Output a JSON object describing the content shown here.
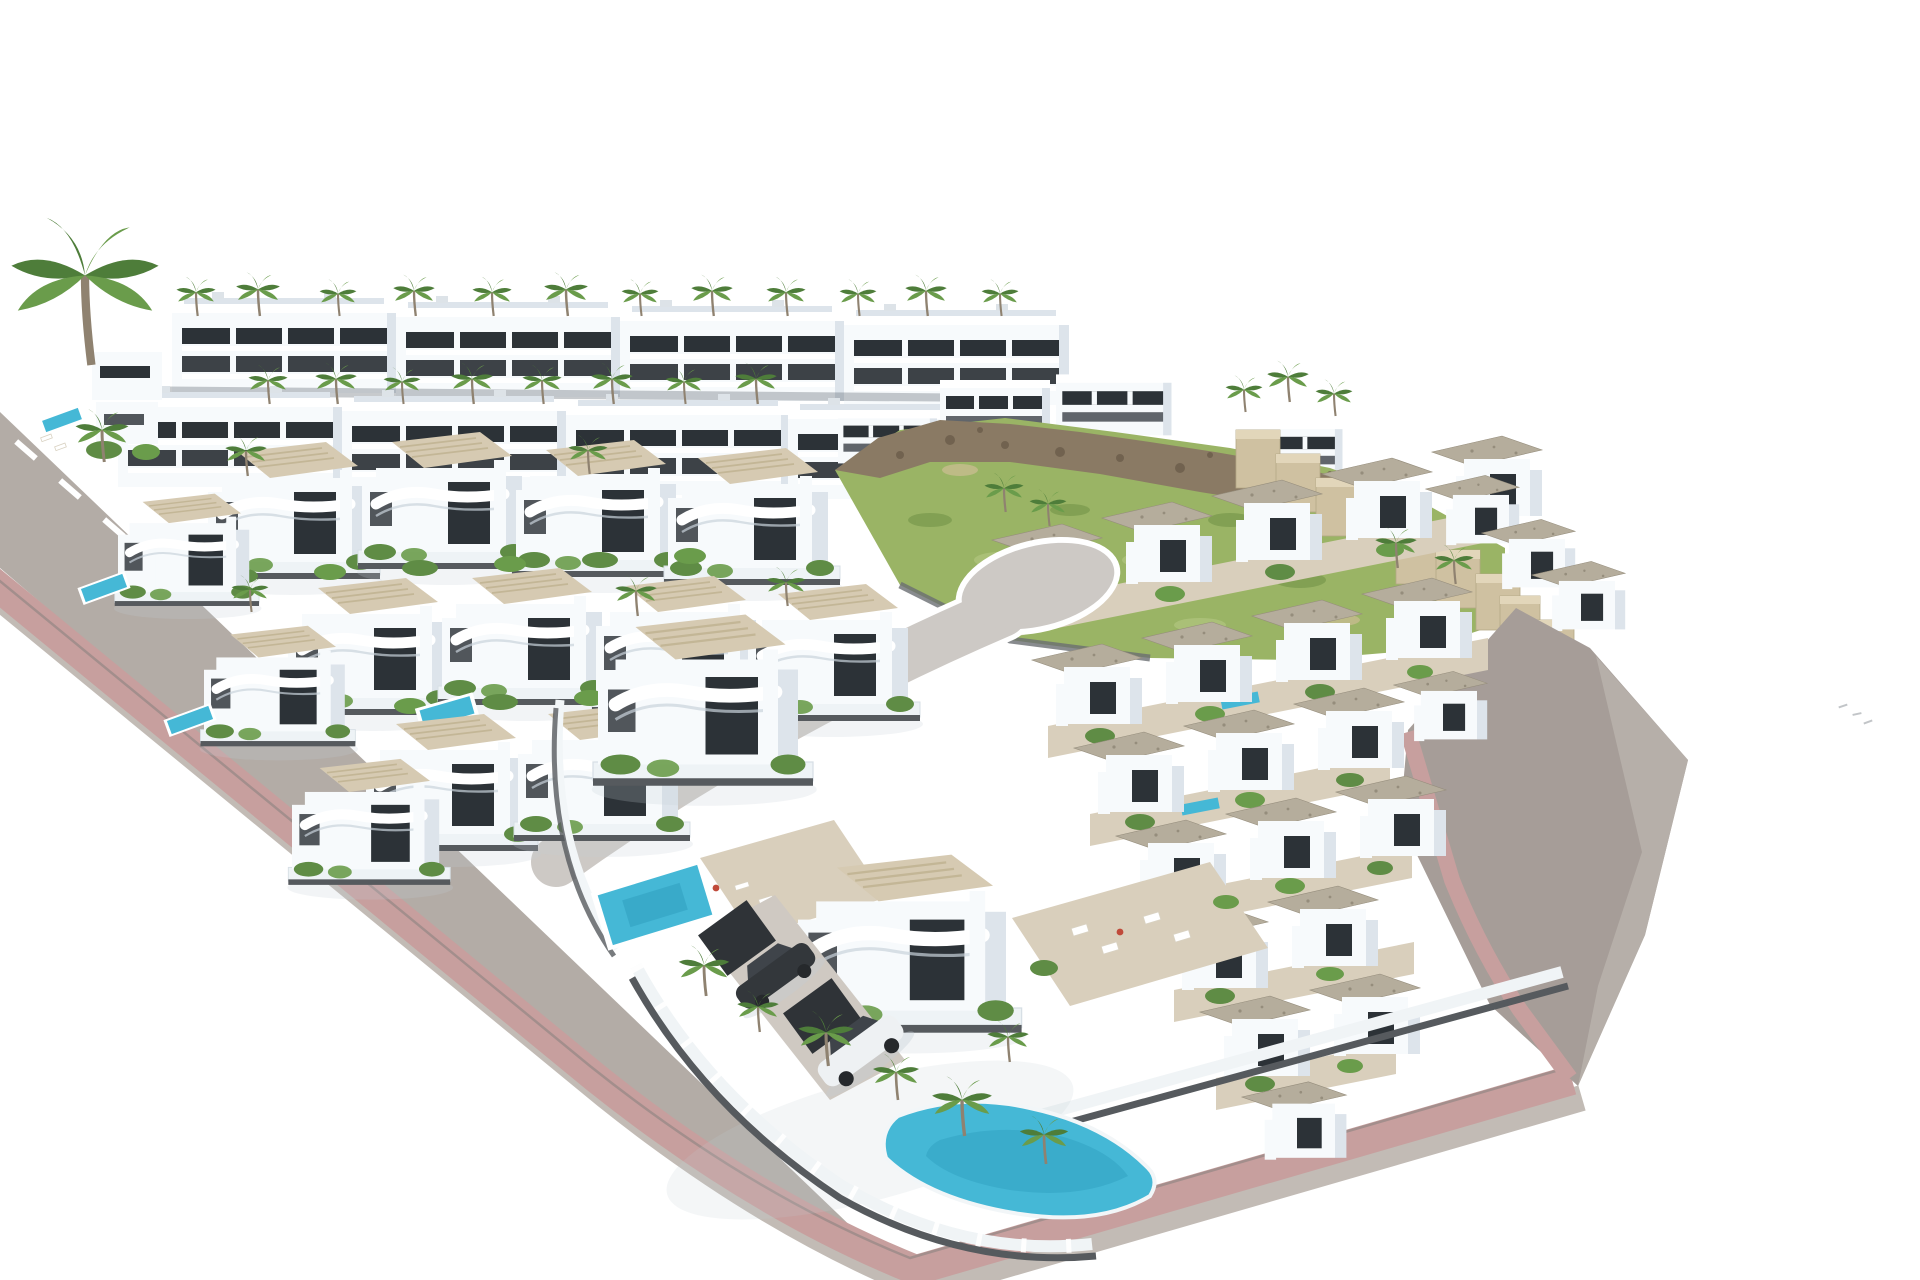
{
  "image": {
    "kind": "3D architectural visualization",
    "subject": "Aerial render of a new hillside residential development: rows of modern white villas and townhouses with gravel flat roofs, private pools, palm trees, glass-fenced gardens and freshly paved streets with pink sidewalks",
    "style": "high-key isometric-style aerial render floating on a plain white background",
    "visible_text": "none"
  },
  "colors": {
    "background": "#ffffff",
    "asphalt": "#b3aca6",
    "asphalt_light": "#c2bbb5",
    "sidewalk_pink": "#c79f9e",
    "curb": "#8a8480",
    "right_road": "#a69d98",
    "embankment": "#b8b1ab",
    "inner_street": "#cdc9c5",
    "marking_white": "#ffffff",
    "building_white": "#f7fafc",
    "building_shade": "#dde4eb",
    "window_dark": "#2c3237",
    "roof_deck": "#d6cab2",
    "gravel_roof": "#b5ad9c",
    "gravel_dot": "#958d7c",
    "fence_dark": "#565a5e",
    "glass_fence": "#eef3f6",
    "terrace_tan": "#d9cfbc",
    "grass": "#9ab465",
    "grass_dark": "#7a9a4e",
    "rock": "#8a7a64",
    "rock_dark": "#6b5d4a",
    "stone_wall": "#cfc1a1",
    "stone_wall_top": "#e2d6ba",
    "pool": "#45b8d6",
    "pool_deep": "#2f9fc0",
    "shrub": "#5f8c45",
    "palm_dark": "#4e7d3a",
    "palm_light": "#6a9c4b",
    "trunk": "#8f8270",
    "car_dark": "#33373b",
    "car_white": "#eef1f3",
    "car_glass": "#3f444a",
    "ground_shadow": "#c3ccd4",
    "person_red": "#c04a3a",
    "person_tan": "#d8b08c",
    "bird_gray": "#9aa0a4"
  },
  "inventory": {
    "apartment_blocks": 8,
    "small_houses_left": 2,
    "hilltop_houses": 4,
    "detached_villas": 15,
    "townhouse_units": 24,
    "swimming_pools": 8,
    "palm_trees": 41,
    "cars": 2,
    "crosswalk_stripes": 6,
    "road_center_dashes": 4,
    "retaining_wall_steps": 9,
    "people": 3,
    "distant_marks": 3
  }
}
